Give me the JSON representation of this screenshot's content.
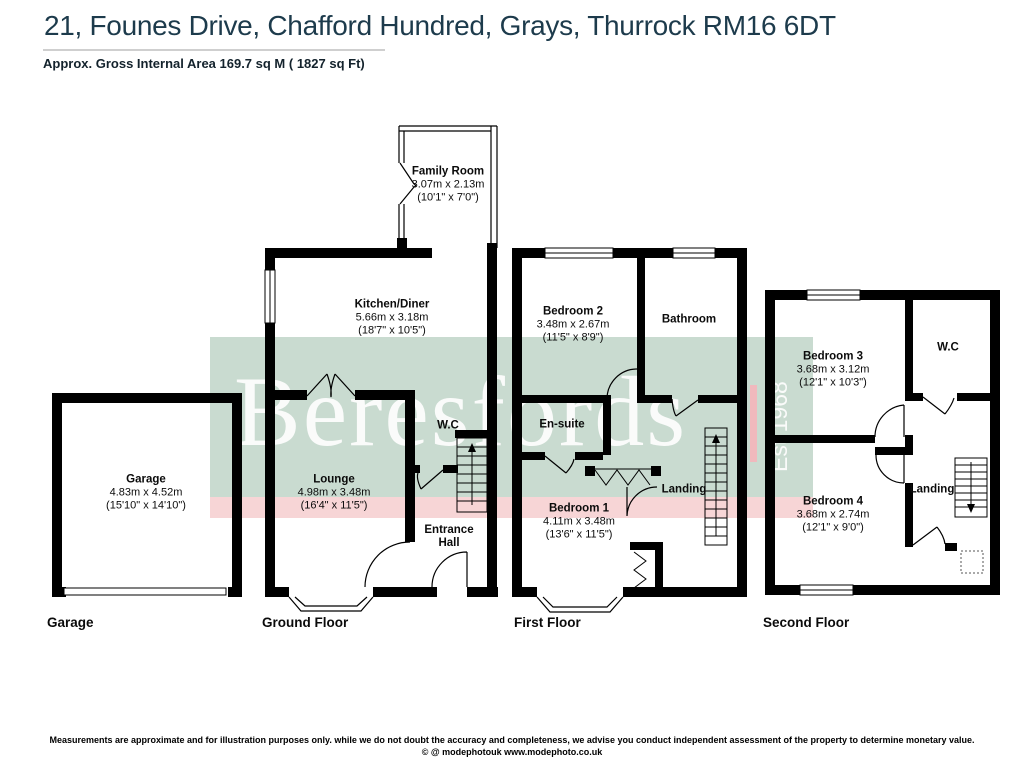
{
  "header": {
    "title": "21, Founes Drive, Chafford Hundred, Grays, Thurrock RM16 6DT",
    "subtitle": "Approx. Gross Internal Area 169.7 sq M ( 1827 sq Ft)"
  },
  "watermark": {
    "brand": "Beresfords",
    "established": "Est 1968",
    "colors": {
      "band_green": "#c9dbd0",
      "band_pink": "#f7d5d6",
      "accent_bar": "#f0b9bd",
      "title_color": "#1d3b4c"
    }
  },
  "floors": {
    "garage": {
      "caption": "Garage",
      "rooms": [
        {
          "name": "Garage",
          "metric": "4.83m x 4.52m",
          "imperial": "(15'10\" x 14'10\")"
        }
      ]
    },
    "ground": {
      "caption": "Ground Floor",
      "rooms": [
        {
          "name": "Family Room",
          "metric": "3.07m x 2.13m",
          "imperial": "(10'1\" x 7'0\")"
        },
        {
          "name": "Kitchen/Diner",
          "metric": "5.66m x 3.18m",
          "imperial": "(18'7\" x 10'5\")"
        },
        {
          "name": "W.C"
        },
        {
          "name": "Lounge",
          "metric": "4.98m x 3.48m",
          "imperial": "(16'4\" x 11'5\")"
        },
        {
          "name": "Entrance Hall"
        }
      ]
    },
    "first": {
      "caption": "First Floor",
      "rooms": [
        {
          "name": "Bedroom 2",
          "metric": "3.48m x 2.67m",
          "imperial": "(11'5\" x 8'9\")"
        },
        {
          "name": "Bathroom"
        },
        {
          "name": "En-suite"
        },
        {
          "name": "Landing"
        },
        {
          "name": "Bedroom 1",
          "metric": "4.11m x 3.48m",
          "imperial": "(13'6\" x 11'5\")"
        }
      ]
    },
    "second": {
      "caption": "Second Floor",
      "rooms": [
        {
          "name": "Bedroom 3",
          "metric": "3.68m x 3.12m",
          "imperial": "(12'1\" x 10'3\")"
        },
        {
          "name": "W.C"
        },
        {
          "name": "Bedroom 4",
          "metric": "3.68m x 2.74m",
          "imperial": "(12'1\" x 9'0\")"
        },
        {
          "name": "Landing"
        }
      ]
    }
  },
  "footer": {
    "disclaimer": "Measurements are approximate and for illustration purposes only. while we do not doubt the accuracy and completeness, we advise you conduct independent assessment of the property to determine monetary value.",
    "credit": "© @ modephotouk www.modephoto.co.uk"
  }
}
